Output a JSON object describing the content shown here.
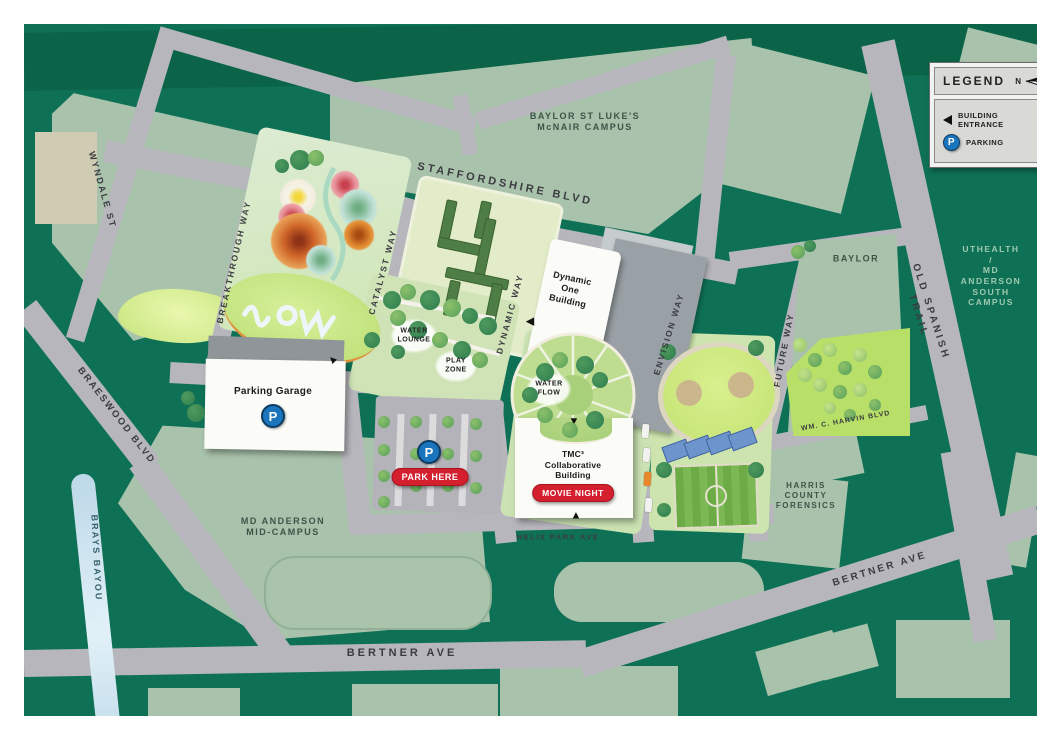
{
  "legend": {
    "title": "LEGEND",
    "north_label": "N",
    "entries": [
      {
        "icon": "building-entrance",
        "label": "BUILDING ENTRANCE"
      },
      {
        "icon": "parking",
        "label": "PARKING"
      }
    ]
  },
  "streets": {
    "staffordshire": "STAFFORDSHIRE BLVD",
    "wyndale": "WYNDALE ST",
    "braeswood": "BRAESWOOD BLVD",
    "brays_bayou": "BRAYS BAYOU",
    "breakthrough": "BREAKTHROUGH WAY",
    "catalyst": "CATALYST WAY",
    "dynamic": "DYNAMIC WAY",
    "envision": "ENVISION WAY",
    "future": "FUTURE WAY",
    "old_spanish_trail": "OLD SPANISH TRAIL",
    "bertner": "BERTNER AVE",
    "bertner_diag": "BERTNER AVE",
    "helix_park": "HELIX PARK AVE",
    "harvin": "WM. C. HARVIN BLVD"
  },
  "areas": {
    "baylor_st_lukes": "BAYLOR ST LUKE'S\nMcNAIR CAMPUS",
    "uthealth": "UTHEALTH /\nMD ANDERSON\nSOUTH CAMPUS",
    "md_anderson": "MD ANDERSON\nMID-CAMPUS",
    "harris_forensics": "HARRIS\nCOUNTY\nFORENSICS",
    "baylor": "BAYLOR"
  },
  "buildings": {
    "parking_garage": "Parking Garage",
    "dynamic_one": "Dynamic\nOne\nBuilding",
    "tmc3": "TMC³\nCollaborative\nBuilding"
  },
  "park_features": {
    "water_lounge": "WATER\nLOUNGE",
    "play_zone": "PLAY\nZONE",
    "water_flow": "WATER\nFLOW"
  },
  "badges": {
    "park_here": "PARK HERE",
    "movie_night": "MOVIE NIGHT"
  },
  "icons": {
    "parking_letter": "P"
  },
  "colors": {
    "map_green": "#0e7155",
    "campus_sage": "#a9c2ab",
    "road_gray": "#b7b6bd",
    "park_light": "#d2e5ba",
    "badge_red": "#d31f2e",
    "parking_blue": "#1b75bc",
    "water_blue": "#cfe3ee"
  }
}
